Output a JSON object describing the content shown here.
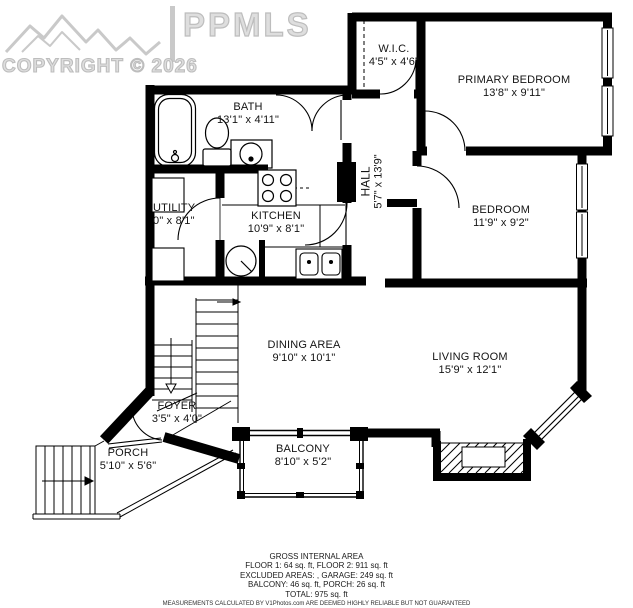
{
  "watermark": {
    "logo": "mountain-logo",
    "brand": "PPMLS",
    "copyright": "COPYRIGHT © 2026"
  },
  "rooms": {
    "wic": {
      "name": "W.I.C.",
      "dims": "4'5\" x 4'6\""
    },
    "primary_bedroom": {
      "name": "PRIMARY BEDROOM",
      "dims": "13'8\" x 9'11\""
    },
    "bath": {
      "name": "BATH",
      "dims": "13'1\" x 4'11\""
    },
    "hall": {
      "name": "HALL",
      "dims": "5'7\" x 13'9\""
    },
    "utility": {
      "name": "UTILITY",
      "dims": "0\" x 8'1\""
    },
    "kitchen": {
      "name": "KITCHEN",
      "dims": "10'9\" x 8'1\""
    },
    "bedroom": {
      "name": "BEDROOM",
      "dims": "11'9\" x 9'2\""
    },
    "dining_area": {
      "name": "DINING AREA",
      "dims": "9'10\" x 10'1\""
    },
    "living_room": {
      "name": "LIVING ROOM",
      "dims": "15'9\" x 12'1\""
    },
    "foyer": {
      "name": "FOYER",
      "dims": "3'5\" x 4'0\""
    },
    "porch": {
      "name": "PORCH",
      "dims": "5'10\" x 5'6\""
    },
    "balcony": {
      "name": "BALCONY",
      "dims": "8'10\" x 5'2\""
    }
  },
  "footer": {
    "title": "GROSS INTERNAL AREA",
    "floors": "FLOOR 1: 64 sq. ft, FLOOR 2: 911 sq. ft",
    "excluded": "EXCLUDED AREAS: , GARAGE: 249 sq. ft",
    "balcony_porch": "BALCONY: 46 sq. ft, PORCH: 26 sq. ft",
    "total": "TOTAL: 975 sq. ft",
    "disclaimer": "MEASUREMENTS CALCULATED BY V1Photos.com ARE DEEMED HIGHLY RELIABLE BUT NOT GUARANTEED"
  },
  "colors": {
    "wall": "#000000",
    "background": "#ffffff",
    "watermark": "#c9c9c9",
    "text": "#1a1a1a"
  }
}
